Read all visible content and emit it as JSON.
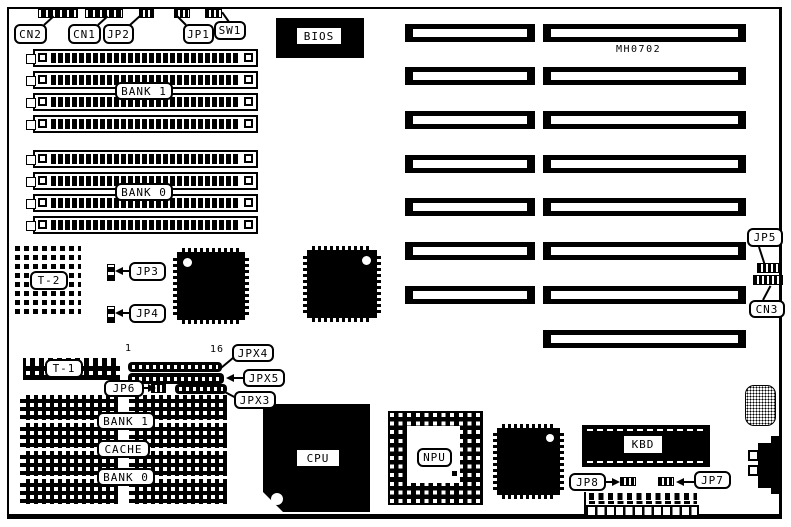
{
  "board": {
    "model": "MH0702"
  },
  "colors": {
    "ink": "#000000",
    "paper": "#ffffff"
  },
  "callouts": {
    "cn2": "CN2",
    "cn1": "CN1",
    "jp2": "JP2",
    "jp1": "JP1",
    "sw1": "SW1",
    "jp3": "JP3",
    "jp4": "JP4",
    "jp5": "JP5",
    "jp6": "JP6",
    "jp7": "JP7",
    "jp8": "JP8",
    "cn3": "CN3",
    "jpx3": "JPX3",
    "jpx4": "JPX4",
    "jpx5": "JPX5"
  },
  "chips": {
    "bios": "BIOS",
    "cpu": "CPU",
    "npu": "NPU",
    "kbd": "KBD"
  },
  "memory": {
    "simm_bank1": "BANK 1",
    "simm_bank0": "BANK 0",
    "dip_bank1": "BANK 1",
    "dip_cache": "CACHE",
    "dip_bank0": "BANK 0",
    "t1": "T-1",
    "t2": "T-2"
  },
  "pins": {
    "first": "1",
    "last": "16"
  }
}
